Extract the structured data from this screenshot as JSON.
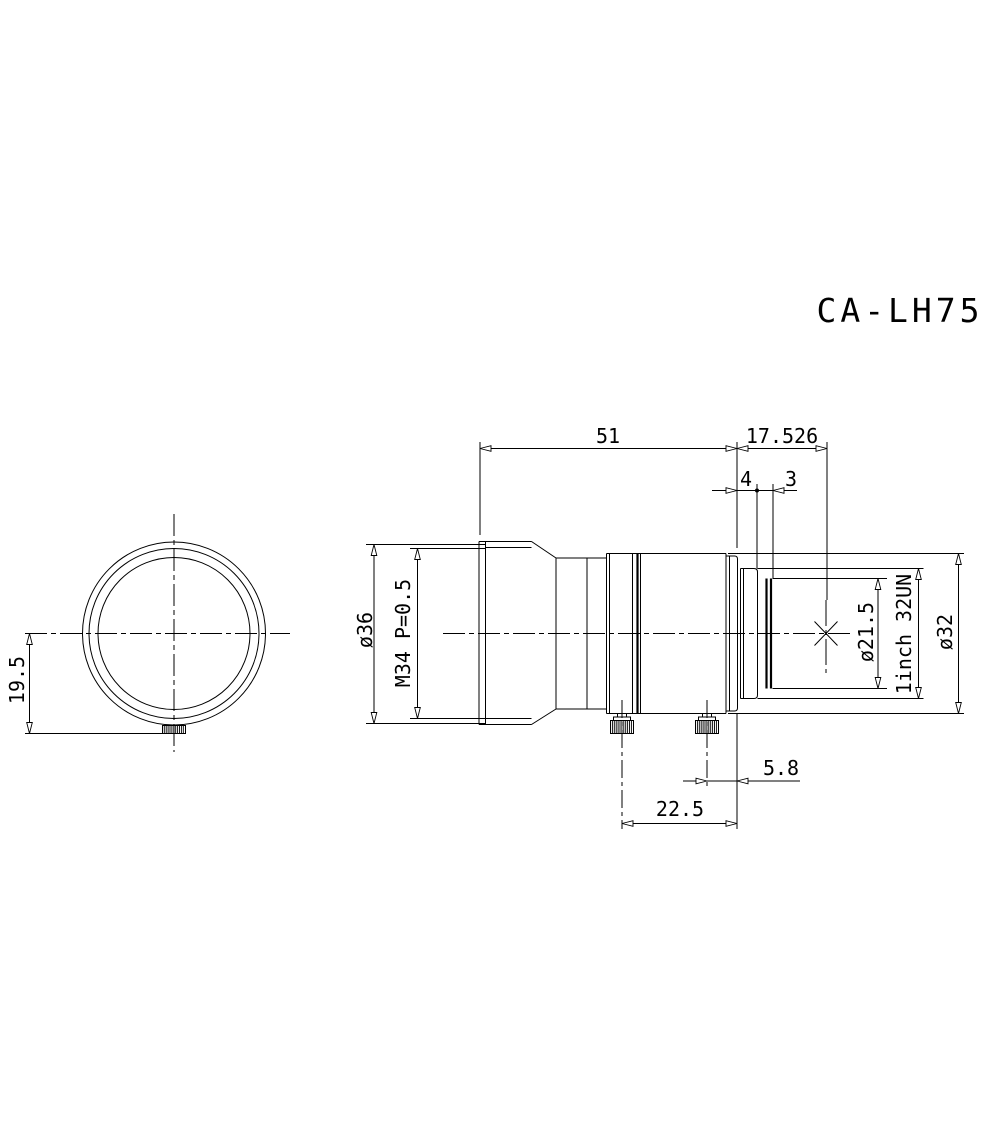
{
  "title": "CA-LH75",
  "colors": {
    "line": "#000000",
    "background": "#ffffff"
  },
  "dims": {
    "d51": "51",
    "d17_526": "17.526",
    "d4": "4",
    "d3": "3",
    "d19_5": "19.5",
    "d36": "ø36",
    "m34": "M34 P=0.5",
    "d21_5": "ø21.5",
    "mount": "1inch 32UN",
    "d32": "ø32",
    "d5_8": "5.8",
    "d22_5": "22.5"
  }
}
